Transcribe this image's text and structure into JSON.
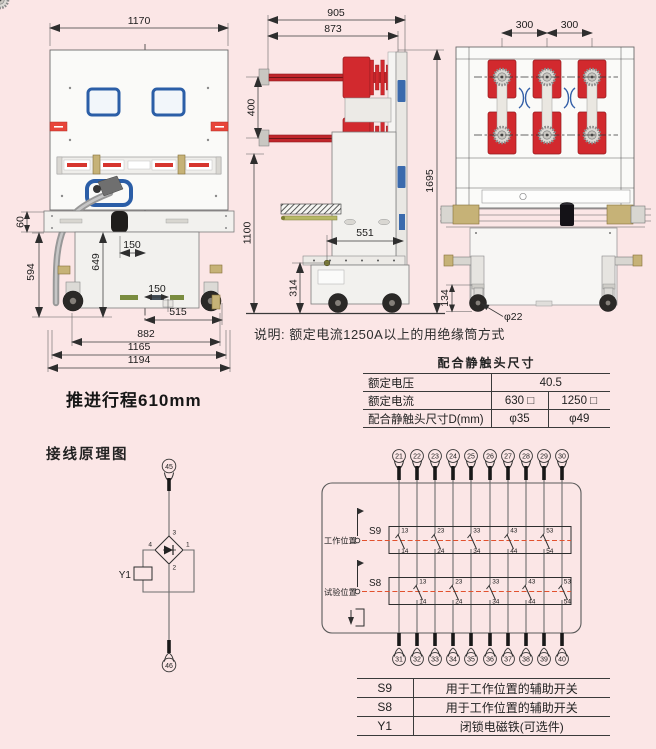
{
  "colors": {
    "background": "#fbe6e6",
    "pole_red": "#d2292e",
    "frame_blue": "#2b5ea7",
    "dashed_line_orange": "#e2512e"
  },
  "front_view": {
    "dim_width_top": "1170",
    "dim_rail_height": "60",
    "dim_left_height": "594",
    "dim_inner_height": "649",
    "dim_gland_offset": "150",
    "dim_center_offset": "150",
    "dim_right_span": "515",
    "dim_wheelbase": "882",
    "dim_frame_width": "1165",
    "dim_total_width": "1194",
    "travel_note": "推进行程610mm"
  },
  "side_view": {
    "dim_depth_total": "905",
    "dim_depth_inner": "873",
    "dim_pole_pitch": "400",
    "dim_total_height": "1695",
    "dim_body_height": "1100",
    "dim_base_depth": "551",
    "dim_pivot_height": "314"
  },
  "rear_view": {
    "dim_phase_pitch_1": "300",
    "dim_phase_pitch_2": "300",
    "dim_wheel_height": "134",
    "dim_wheel_dia": "φ22"
  },
  "note": "说明: 额定电流1250A以上的用绝缘筒方式",
  "contact_table": {
    "title": "配合静触头尺寸",
    "row1_label": "额定电压",
    "row1_value": "40.5",
    "row2_label": "额定电流",
    "row2_v1": "630 □",
    "row2_v2": "1250 □",
    "row3_label": "配合静触头尺寸D(mm)",
    "row3_v1": "φ35",
    "row3_v2": "φ49"
  },
  "wiring": {
    "title": "接线原理图",
    "y1": {
      "top_terminal": "45",
      "bottom_terminal": "46",
      "coil": "Y1",
      "pin_top": "3",
      "pin_left": "4",
      "pin_right": "1",
      "pin_bottom": "2"
    },
    "relay": {
      "s9": "S9",
      "s8": "S8",
      "work_position": "工作位置",
      "test_position": "试验位置",
      "top_terminals": [
        "21",
        "22",
        "23",
        "24",
        "25",
        "26",
        "27",
        "28",
        "29",
        "30"
      ],
      "bottom_terminals": [
        "31",
        "32",
        "33",
        "34",
        "35",
        "36",
        "37",
        "38",
        "39",
        "40"
      ],
      "s9_contacts": [
        {
          "t": "13",
          "b": "14"
        },
        {
          "t": "23",
          "b": "24"
        },
        {
          "t": "33",
          "b": "34"
        },
        {
          "t": "43",
          "b": "44"
        },
        {
          "t": "53",
          "b": "54"
        }
      ],
      "s8_contacts": [
        {
          "t": "13",
          "b": "14"
        },
        {
          "t": "23",
          "b": "24"
        },
        {
          "t": "33",
          "b": "34"
        },
        {
          "t": "43",
          "b": "44"
        },
        {
          "t": "53",
          "b": "54"
        }
      ]
    }
  },
  "legend_table": {
    "rows": [
      {
        "code": "S9",
        "desc": "用于工作位置的辅助开关"
      },
      {
        "code": "S8",
        "desc": "用于工作位置的辅助开关"
      },
      {
        "code": "Y1",
        "desc": "闭锁电磁铁(可选件)"
      }
    ]
  }
}
